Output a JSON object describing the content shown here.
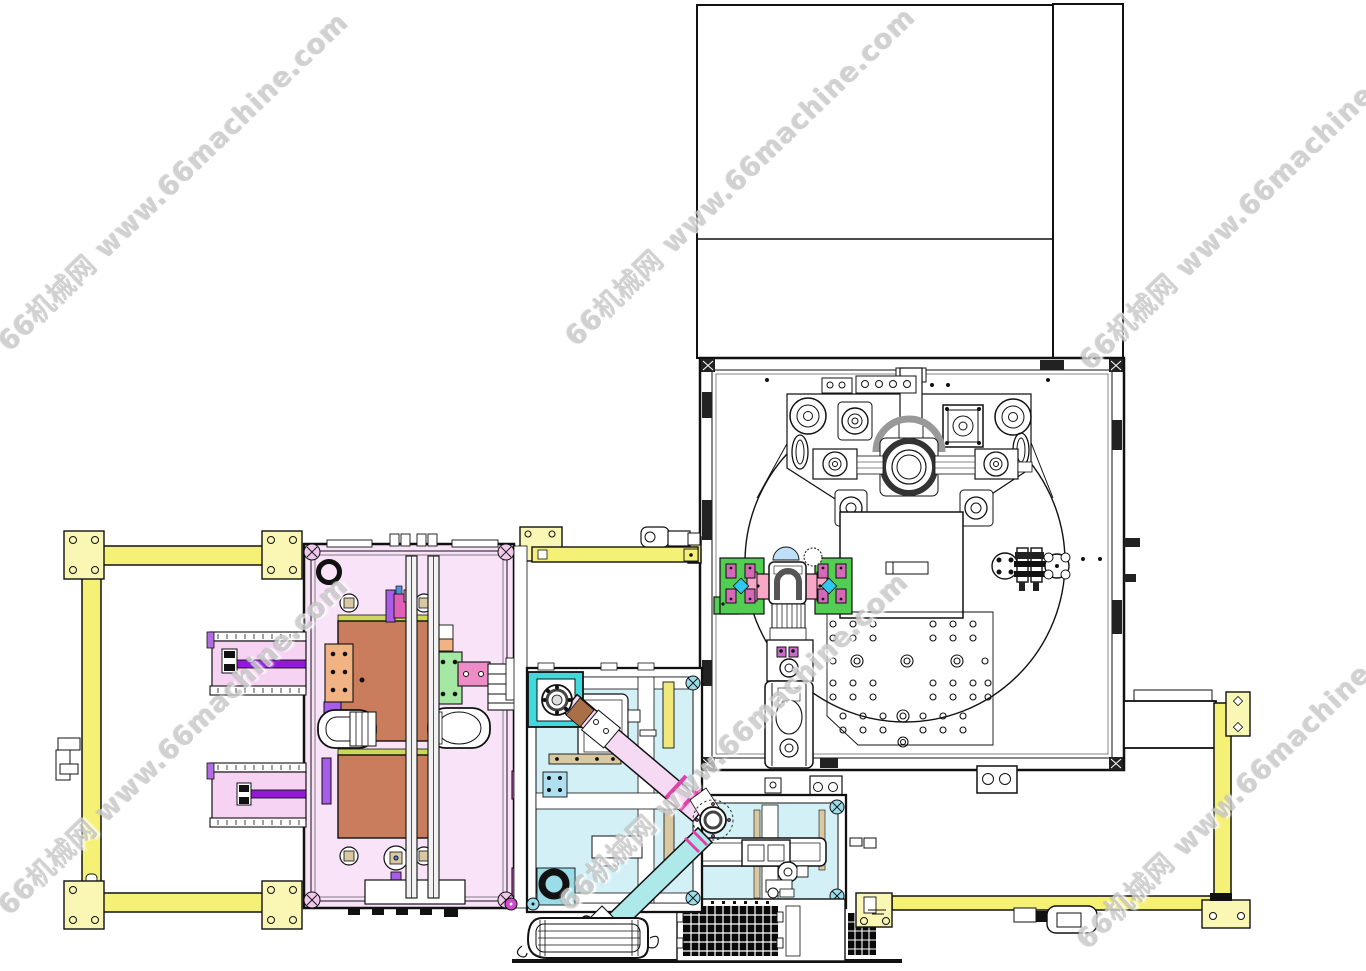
{
  "watermark": {
    "text": "66机械网 www.66machine.com"
  },
  "drawing": {
    "description": "CAD top view layout of automated assembly line",
    "stations": [
      "electrical-enclosure",
      "rotary-table-station",
      "pallet-fixture-station",
      "vertical-transfer-unit",
      "scara-robot-cell",
      "left-loading-machine",
      "tray-conveyors",
      "safety-frame-left",
      "safety-frame-right",
      "linear-actuator-box",
      "vent-grille",
      "feeder-block"
    ]
  },
  "colors": {
    "line": "#111111",
    "yellow": "#F5F176",
    "yellow-pale": "#FAF7B4",
    "pink-machine": "#F9E3F9",
    "brown": "#C97D5D",
    "green-top-band": "#CCD85C",
    "green-fixture": "#52CE52",
    "pink-bar": "#F8A8C6",
    "cyan-diamond": "#2FC8EF",
    "sky-blue": "#BFE0F8",
    "turquoise": "#3FDBDB",
    "cyan-machine": "#D2F0F5",
    "pink-link": "#F6D9F2",
    "cyan-link": "#AEE9E9",
    "magenta": "#CC4CCC",
    "magenta-clamp": "#D668B8",
    "purple": "#A85CE8",
    "purple-rod": "#9318D8",
    "conveyor-pink": "#F7D3F3",
    "orange": "#F2B384",
    "green-plate": "#A4E8A4",
    "tan": "#D9C9A2",
    "pale-blue": "#AEE0F0",
    "yellow-strip": "#F0E878",
    "pad-cyan": "#9ADCE8",
    "bracket-pink": "#F0C8EC",
    "watermark-gray": "#C9C9C9"
  }
}
